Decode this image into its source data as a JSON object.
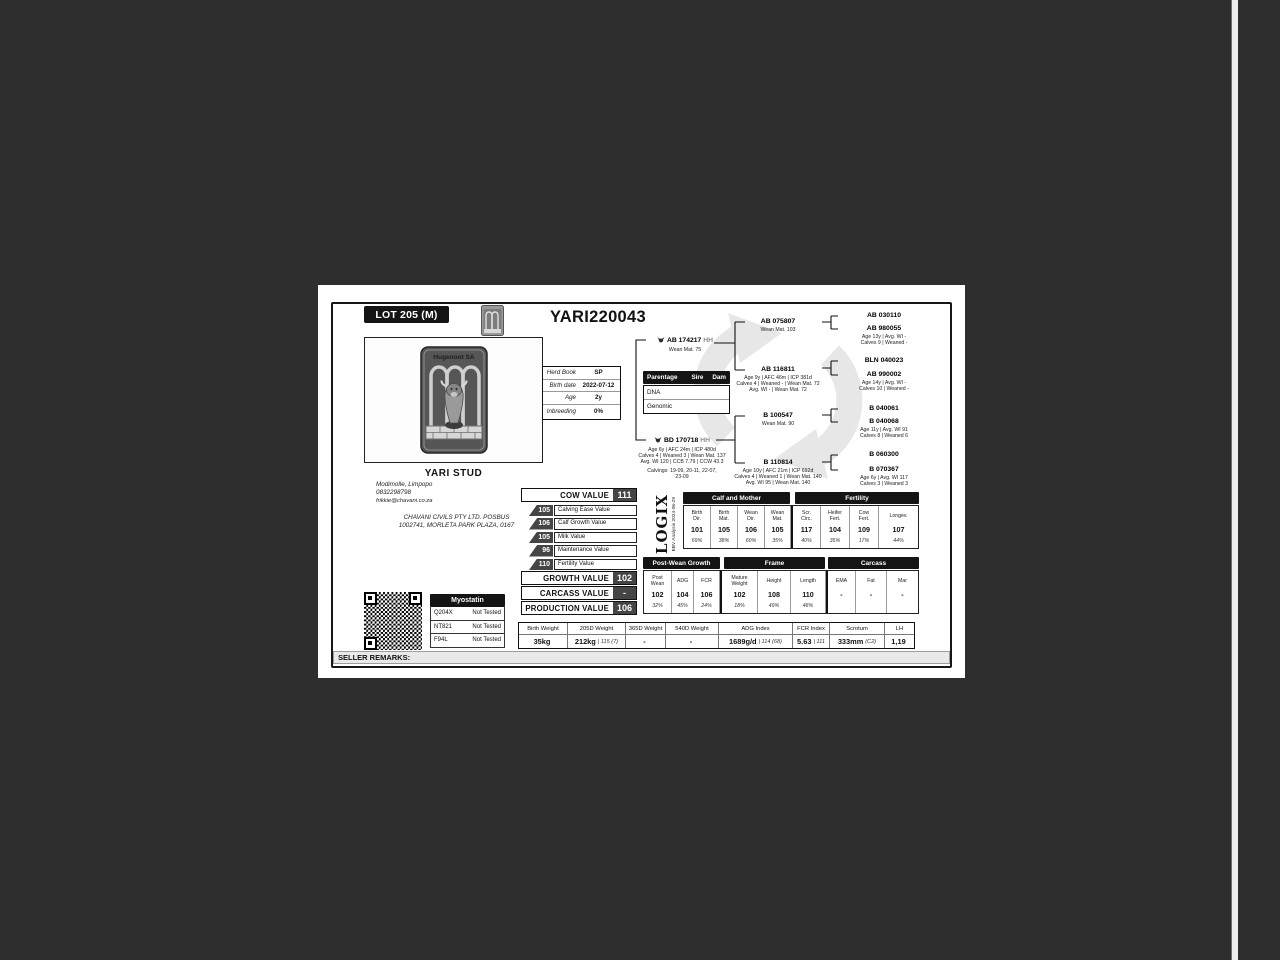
{
  "header": {
    "lot": "LOT 205 (M)",
    "title": "YARI220043"
  },
  "stud": {
    "brand_name": "Hugenoot SA",
    "name": "YARI STUD",
    "location": "Modimolle, Limpopo",
    "phone": "0832298798",
    "email": "frikkie@chavani.co.za",
    "company_line1": "CHAVANI CIVILS PTY LTD. POSBUS",
    "company_line2": "1002741, MORLETA PARK PLAZA, 0167"
  },
  "details": {
    "rows": [
      {
        "label": "Herd Book",
        "value": "SP"
      },
      {
        "label": "Birth date",
        "value": "2022-07-12"
      },
      {
        "label": "Age",
        "value": "2y"
      },
      {
        "label": "Inbreeding",
        "value": "0%"
      }
    ]
  },
  "parentage": {
    "title": "Parentage",
    "sire_col": "Sire",
    "dam_col": "Dam",
    "rows": [
      {
        "label": "DNA"
      },
      {
        "label": "Genomic"
      }
    ]
  },
  "pedigree": {
    "sire": {
      "name": "AB 174217",
      "tag": "HH",
      "line1": "Wean Mat. 75"
    },
    "dam": {
      "name": "BD 170718",
      "tag": "HH",
      "line1": "Age 6y | AFC 24m | ICP 480d",
      "line2": "Calves 4 | Weaned 3 | Wean Mat. 137",
      "line3": "Avg. WI 120 | CCB 7.79 | CCW 43.3",
      "line4": "Calvings: 19-09, 20-11, 22-07,",
      "line5": "23-09"
    },
    "sire_sire": {
      "name": "AB 075807",
      "line1": "Wean Mat. 103"
    },
    "sire_dam": {
      "name": "AB 116811",
      "line1": "Age 9y | AFC 46m | ICP 381d",
      "line2": "Calves 4 | Weaned - | Wean Mat. 72",
      "line3": "Avg. WI - | Wean Mat. 72"
    },
    "dam_sire": {
      "name": "B 100547",
      "line1": "Wean Mat. 90"
    },
    "dam_dam": {
      "name": "B 110814",
      "line1": "Age 10y | AFC 21m | ICP 692d",
      "line2": "Calves 4 | Weaned 1 | Wean Mat. 140",
      "line3": "Avg. WI 95 | Wean Mat. 140"
    },
    "ggp": [
      {
        "name": "AB 030110",
        "line1": "",
        "line2": ""
      },
      {
        "name": "AB 980055",
        "line1": "Age 13y | Avg. WI -",
        "line2": "Calves 9 | Weaned -"
      },
      {
        "name": "BLN 040023",
        "line1": "",
        "line2": ""
      },
      {
        "name": "AB 990002",
        "line1": "Age 14y | Avg. WI -",
        "line2": "Calves 10 | Weaned -"
      },
      {
        "name": "B 040061",
        "line1": "",
        "line2": ""
      },
      {
        "name": "B 040068",
        "line1": "Age 11y | Avg. WI 91",
        "line2": "Calves 8 | Weaned 6"
      },
      {
        "name": "B 060300",
        "line1": "",
        "line2": ""
      },
      {
        "name": "B 070367",
        "line1": "Age 6y | Avg. WI 117",
        "line2": "Calves 3 | Weaned 3"
      }
    ]
  },
  "values": {
    "cow": {
      "label": "COW VALUE",
      "value": "111"
    },
    "subs": [
      {
        "value": "105",
        "label": "Calving Ease Value"
      },
      {
        "value": "106",
        "label": "Calf Growth Value"
      },
      {
        "value": "105",
        "label": "Milk Value"
      },
      {
        "value": "96",
        "label": "Maintenance Value"
      },
      {
        "value": "110",
        "label": "Fertility Value"
      }
    ],
    "growth": {
      "label": "GROWTH VALUE",
      "value": "102"
    },
    "carcass": {
      "label": "CARCASS VALUE",
      "value": "-"
    },
    "production": {
      "label": "PRODUCTION VALUE",
      "value": "106"
    }
  },
  "logix": {
    "brand": "LOGIX",
    "analysis": "EBV Analysis 2024-06-29"
  },
  "ebv_top": {
    "group1_title": "Calf and Mother",
    "group2_title": "Fertility",
    "cols": [
      {
        "h1": "Birth",
        "h2": "Dir.",
        "value": "101",
        "acc": "69%"
      },
      {
        "h1": "Birth",
        "h2": "Mat.",
        "value": "105",
        "acc": "38%"
      },
      {
        "h1": "Wean",
        "h2": "Dir.",
        "value": "106",
        "acc": "60%"
      },
      {
        "h1": "Wean",
        "h2": "Mat.",
        "value": "105",
        "acc": "35%"
      },
      {
        "h1": "Scr.",
        "h2": "Circ.",
        "value": "117",
        "acc": "40%"
      },
      {
        "h1": "Heifer",
        "h2": "Fert.",
        "value": "104",
        "acc": "35%"
      },
      {
        "h1": "Cow",
        "h2": "Fert.",
        "value": "109",
        "acc": "17%"
      },
      {
        "h1": "Longev.",
        "h2": "",
        "value": "107",
        "acc": "44%"
      }
    ]
  },
  "ebv_bottom": {
    "group1_title": "Post-Wean Growth",
    "group2_title": "Frame",
    "group3_title": "Carcass",
    "cols": [
      {
        "h1": "Post",
        "h2": "Wean",
        "value": "102",
        "acc": "32%"
      },
      {
        "h1": "ADG",
        "h2": "",
        "value": "104",
        "acc": "45%"
      },
      {
        "h1": "FCR",
        "h2": "",
        "value": "106",
        "acc": "24%"
      },
      {
        "h1": "Mature",
        "h2": "Weight",
        "value": "102",
        "acc": "18%"
      },
      {
        "h1": "Height",
        "h2": "",
        "value": "108",
        "acc": "49%"
      },
      {
        "h1": "Length",
        "h2": "",
        "value": "110",
        "acc": "48%"
      },
      {
        "h1": "EMA",
        "h2": "",
        "value": "-",
        "acc": ""
      },
      {
        "h1": "Fat",
        "h2": "",
        "value": "-",
        "acc": ""
      },
      {
        "h1": "Mar",
        "h2": "",
        "value": "-",
        "acc": ""
      }
    ]
  },
  "weights": {
    "cols": [
      {
        "header": "Birth Weight",
        "value": "35kg",
        "extra": ""
      },
      {
        "header": "205D Weight",
        "value": "212kg",
        "extra": "| 115 (7)"
      },
      {
        "header": "365D Weight",
        "value": "-",
        "extra": ""
      },
      {
        "header": "540D Weight",
        "value": "-",
        "extra": ""
      },
      {
        "header": "ADG Index",
        "value": "1689g/d",
        "extra": "| 114 (68)"
      },
      {
        "header": "FCR Index",
        "value": "5.63",
        "extra": "| 111"
      },
      {
        "header": "Scrotum",
        "value": "333mm",
        "extra": "(C2)"
      },
      {
        "header": "LH",
        "value": "1,19",
        "extra": ""
      }
    ]
  },
  "myostatin": {
    "title": "Myostatin",
    "rows": [
      {
        "gene": "Q204X",
        "result": "Not Tested"
      },
      {
        "gene": "NT821",
        "result": "Not Tested"
      },
      {
        "gene": "F94L",
        "result": "Not Tested"
      }
    ]
  },
  "footer": {
    "seller_remarks": "SELLER REMARKS:"
  }
}
